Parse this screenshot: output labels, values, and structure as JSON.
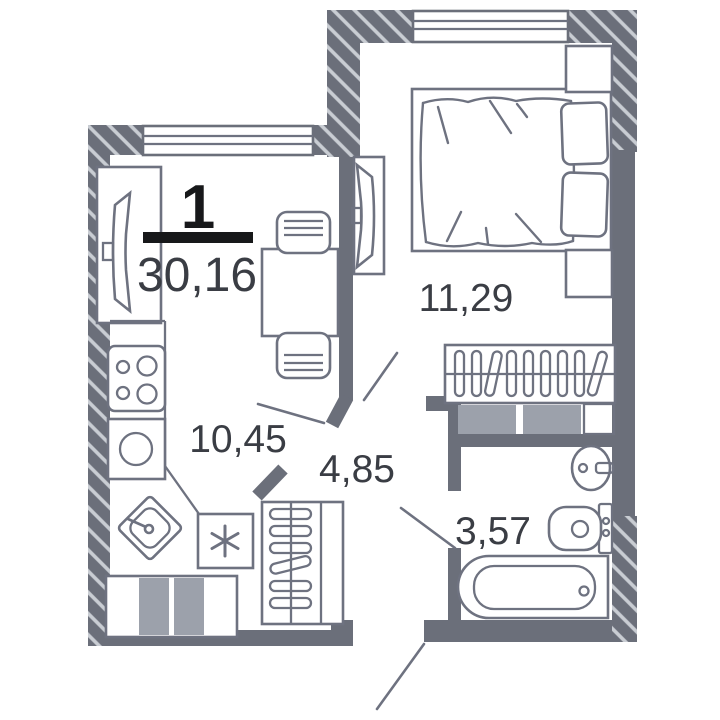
{
  "plan": {
    "room_count_label": "1",
    "total_area": "30,16",
    "areas": {
      "living_kitchen": "10,45",
      "bedroom": "11,29",
      "hallway": "4,85",
      "bathroom": "3,57"
    },
    "colors": {
      "wall": "#6b6f7a",
      "hatch_stripe": "#c9cdd3",
      "furniture_outline": "#6e7280",
      "appliance_fill": "#9ca1ab",
      "label_dark": "#17181a",
      "label_gray": "#3a3d44",
      "background": "#ffffff"
    }
  }
}
